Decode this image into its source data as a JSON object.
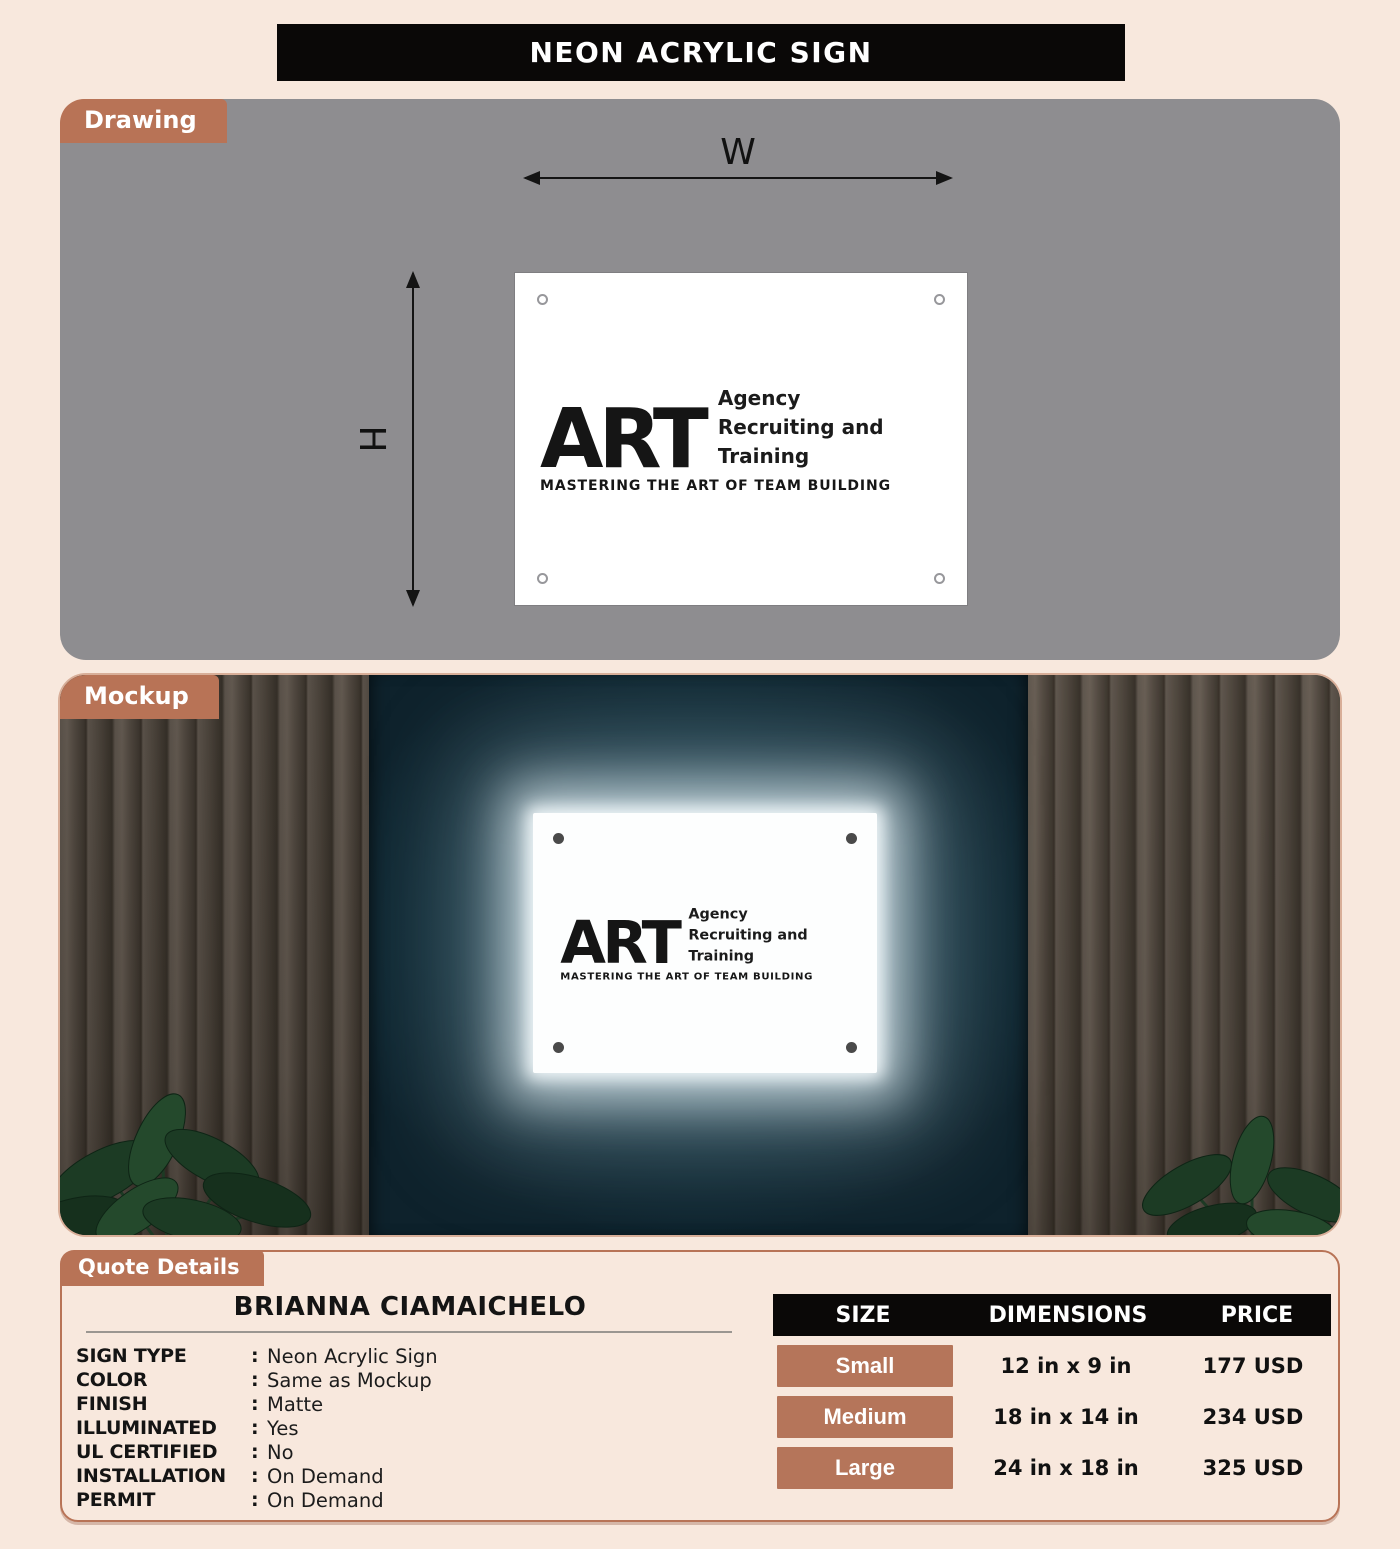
{
  "page": {
    "title": "NEON ACRYLIC SIGN"
  },
  "colors": {
    "background": "#f8e8dd",
    "accent_terracotta": "#b87356",
    "header_black": "#0a0807",
    "drawing_gray": "#8e8d90",
    "wall_teal": "#15323d",
    "sign_white": "#ffffff"
  },
  "drawing": {
    "tab_label": "Drawing",
    "width_label": "W",
    "height_label": "H"
  },
  "logo": {
    "wordmark": "ART",
    "tagline_lines": [
      "Agency",
      "Recruiting and",
      "Training"
    ],
    "subtitle": "MASTERING THE ART OF TEAM BUILDING"
  },
  "mockup": {
    "tab_label": "Mockup"
  },
  "quote": {
    "tab_label": "Quote Details",
    "customer_name": "BRIANNA CIAMAICHELO",
    "colon": ":",
    "specs": [
      {
        "label": "SIGN TYPE",
        "value": "Neon Acrylic Sign"
      },
      {
        "label": "COLOR",
        "value": "Same as Mockup"
      },
      {
        "label": "FINISH",
        "value": "Matte"
      },
      {
        "label": "ILLUMINATED",
        "value": "Yes"
      },
      {
        "label": "UL CERTIFIED",
        "value": "No"
      },
      {
        "label": "INSTALLATION",
        "value": "On Demand"
      },
      {
        "label": "PERMIT",
        "value": "On Demand"
      }
    ],
    "pricing_table": {
      "headers": [
        "SIZE",
        "DIMENSIONS",
        "PRICE"
      ],
      "rows": [
        {
          "size": "Small",
          "dimensions": "12 in x 9 in",
          "price": "177 USD"
        },
        {
          "size": "Medium",
          "dimensions": "18 in x 14 in",
          "price": "234 USD"
        },
        {
          "size": "Large",
          "dimensions": "24 in x 18 in",
          "price": "325 USD"
        }
      ]
    }
  }
}
